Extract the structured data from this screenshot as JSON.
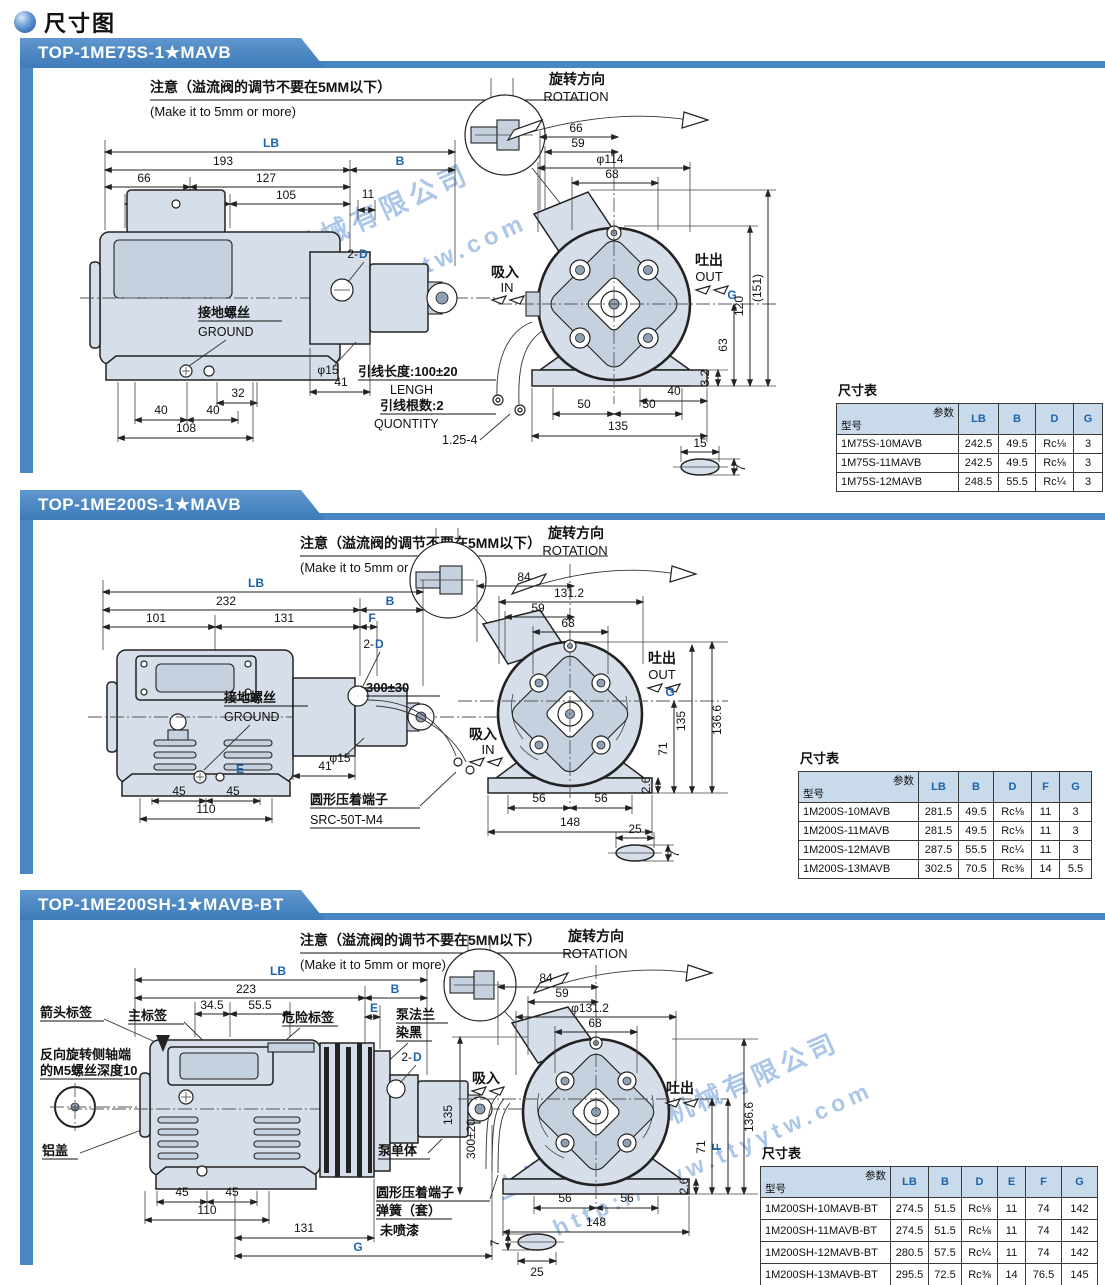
{
  "page": {
    "title": "尺寸图"
  },
  "watermark": {
    "company": "上海台拓液压机械有限公司",
    "url": "http://www.ttyytw.com"
  },
  "note": {
    "cn": "注意（溢流阀的调节不要在5MM以下）",
    "en": "(Make it to 5mm or more)"
  },
  "rotation": {
    "cn": "旋转方向",
    "en": "ROTATION"
  },
  "sections": [
    {
      "header": "TOP-1ME75S-1★MAVB",
      "d": {
        "lb": "LB",
        "n193": "193",
        "b": "B",
        "n66": "66",
        "n127": "127",
        "n70": "70",
        "n105": "105",
        "n11": "11",
        "twoD_pre": "2-",
        "twoD_d": "D",
        "ground_cn": "接地螺丝",
        "ground_en": "GROUND",
        "phi15": "φ15",
        "n41": "41",
        "n32": "32",
        "n40a": "40",
        "n40b": "40",
        "n108": "108",
        "lead1_cn": "引线长度:100±20",
        "lead1_en": "LENGH",
        "lead2_cn": "引线根数:2",
        "lead2_en": "QUONTITY",
        "lead3": "1.25-4",
        "f66": "66",
        "f59": "59",
        "f114": "φ114",
        "f68": "68",
        "in_cn": "吸入",
        "in_en": "IN",
        "out_cn": "吐出",
        "out_en": "OUT",
        "g": "G",
        "n120": "120",
        "n151": "(151)",
        "n63": "63",
        "n32b": "3.2",
        "n40c": "40",
        "n50a": "50",
        "n50b": "50",
        "n135": "135",
        "s15": "15",
        "s7": "7"
      },
      "table": {
        "title": "尺寸表",
        "diag_top": "参数",
        "diag_bottom": "型号",
        "columns": [
          "LB",
          "B",
          "D",
          "G"
        ],
        "rows": [
          {
            "model": "1M75S-10MAVB",
            "v": [
              "242.5",
              "49.5",
              "Rc⅛",
              "3"
            ]
          },
          {
            "model": "1M75S-11MAVB",
            "v": [
              "242.5",
              "49.5",
              "Rc⅛",
              "3"
            ]
          },
          {
            "model": "1M75S-12MAVB",
            "v": [
              "248.5",
              "55.5",
              "Rc¼",
              "3"
            ]
          }
        ]
      }
    },
    {
      "header": "TOP-1ME200S-1★MAVB",
      "d": {
        "lb": "LB",
        "n232": "232",
        "b": "B",
        "n101": "101",
        "n131": "131",
        "f": "F",
        "twoD_pre": "2-",
        "twoD_d": "D",
        "ground_cn": "接地螺丝",
        "ground_en": "GROUND",
        "phi15": "φ15",
        "n41": "41",
        "e": "E",
        "n45a": "45",
        "n45b": "45",
        "n110": "110",
        "term_cn": "圆形压着端子",
        "term_md": "SRC-50T-M4",
        "n300": "300±30",
        "f84": "84",
        "f1312": "131.2",
        "f59": "59",
        "f68": "68",
        "in_cn": "吸入",
        "in_en": "IN",
        "out_cn": "吐出",
        "out_en": "OUT",
        "g": "G",
        "v135": "135",
        "v1366": "136.6",
        "v71": "71",
        "v26": "2.6",
        "n56a": "56",
        "n56b": "56",
        "n148": "148",
        "s25": "25",
        "s7": "7"
      },
      "table": {
        "title": "尺寸表",
        "diag_top": "参数",
        "diag_bottom": "型号",
        "columns": [
          "LB",
          "B",
          "D",
          "F",
          "G"
        ],
        "rows": [
          {
            "model": "1M200S-10MAVB",
            "v": [
              "281.5",
              "49.5",
              "Rc⅛",
              "11",
              "3"
            ]
          },
          {
            "model": "1M200S-11MAVB",
            "v": [
              "281.5",
              "49.5",
              "Rc⅛",
              "11",
              "3"
            ]
          },
          {
            "model": "1M200S-12MAVB",
            "v": [
              "287.5",
              "55.5",
              "Rc¼",
              "11",
              "3"
            ]
          },
          {
            "model": "1M200S-13MAVB",
            "v": [
              "302.5",
              "70.5",
              "Rc⅜",
              "14",
              "5.5"
            ]
          }
        ]
      }
    },
    {
      "header": "TOP-1ME200SH-1★MAVB-BT",
      "d": {
        "lb": "LB",
        "n223": "223",
        "b": "B",
        "n345": "34.5",
        "n555": "55.5",
        "e": "E",
        "lbl_arrow": "箭头标签",
        "lbl_main": "主标签",
        "lbl_danger": "危险标签",
        "lbl_flange1": "泵法兰",
        "lbl_flange2": "染黑",
        "shaft1": "反向旋转侧轴端",
        "shaft2": "的M5螺丝深度10",
        "alu": "铝盖",
        "twoD_pre": "2-",
        "twoD_d": "D",
        "pump_unit": "泵单体",
        "term1": "圆形压着端子",
        "term2": "弹簧（套）",
        "term3": "未喷漆",
        "n45a": "45",
        "n45b": "45",
        "n110": "110",
        "n131": "131",
        "g": "G",
        "f84": "84",
        "f59": "59",
        "f1312": "φ131.2",
        "f68": "68",
        "in_cn": "吸入",
        "out_cn": "吐出",
        "v135": "135",
        "v300": "300±20",
        "v1366": "136.6",
        "v71": "71",
        "f": "F",
        "v26": "2.6",
        "n56a": "56",
        "n56b": "56",
        "n148": "148",
        "s7": "7",
        "s25": "25"
      },
      "table": {
        "title": "尺寸表",
        "diag_top": "参数",
        "diag_bottom": "型号",
        "columns": [
          "LB",
          "B",
          "D",
          "E",
          "F",
          "G"
        ],
        "rows": [
          {
            "model": "1M200SH-10MAVB-BT",
            "v": [
              "274.5",
              "51.5",
              "Rc⅛",
              "11",
              "74",
              "142"
            ]
          },
          {
            "model": "1M200SH-11MAVB-BT",
            "v": [
              "274.5",
              "51.5",
              "Rc⅛",
              "11",
              "74",
              "142"
            ]
          },
          {
            "model": "1M200SH-12MAVB-BT",
            "v": [
              "280.5",
              "57.5",
              "Rc¼",
              "11",
              "74",
              "142"
            ]
          },
          {
            "model": "1M200SH-13MAVB-BT",
            "v": [
              "295.5",
              "72.5",
              "Rc⅜",
              "14",
              "76.5",
              "145"
            ]
          }
        ]
      }
    }
  ]
}
